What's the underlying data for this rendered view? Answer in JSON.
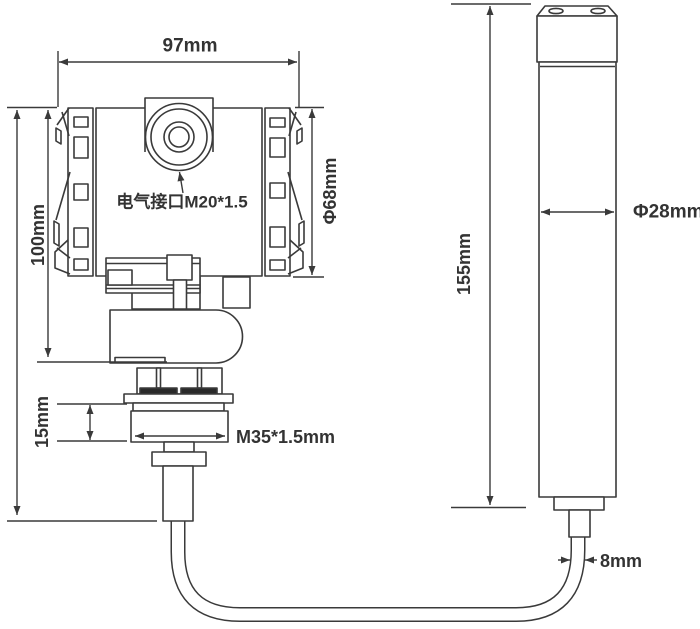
{
  "drawing": {
    "title": "transmitter-and-probe-dimension-drawing",
    "transmitter": {
      "width": "97mm",
      "height": "100mm",
      "body_diameter": "Φ68mm",
      "electrical_port": "电气接口M20*1.5",
      "process_thread": "M35*1.5mm",
      "thread_section_height": "15mm"
    },
    "probe": {
      "length": "155mm",
      "diameter": "Φ28mm",
      "cable_diameter": "8mm"
    },
    "colors": {
      "line": "#3a3a3a",
      "text": "#333333",
      "background": "#ffffff"
    }
  }
}
